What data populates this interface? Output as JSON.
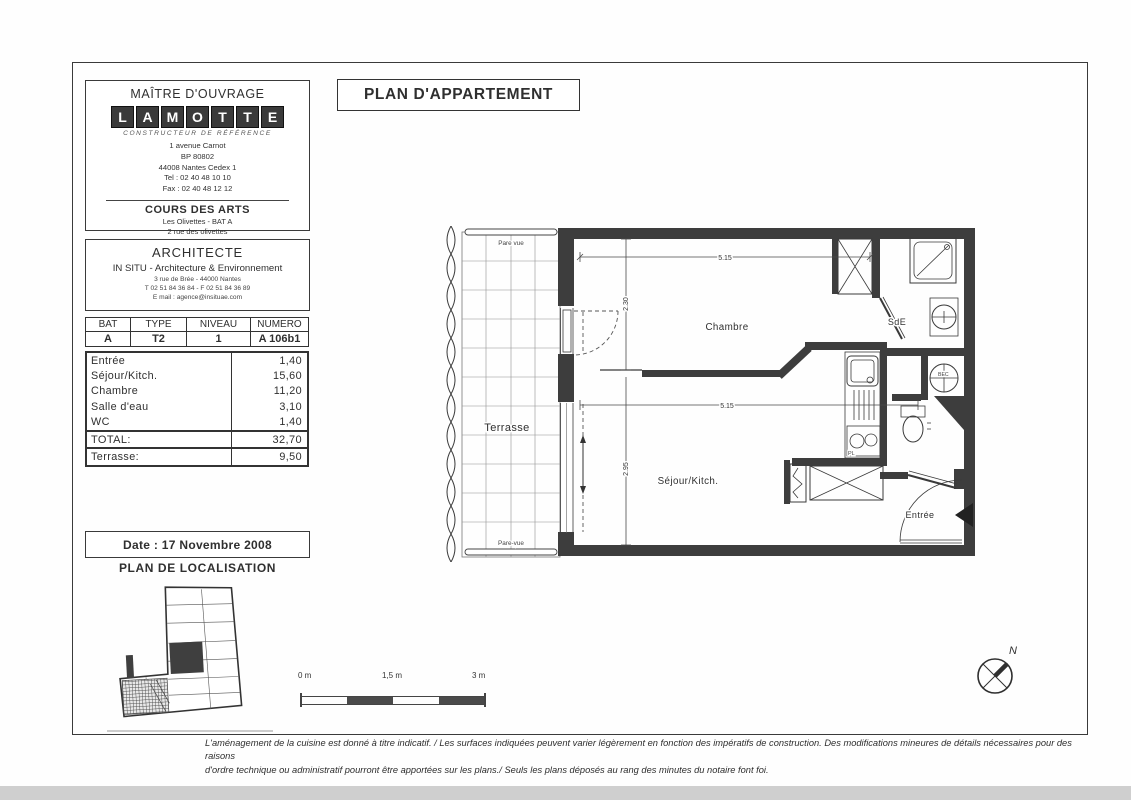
{
  "colors": {
    "ink": "#2f2f2f",
    "wall": "#3d3d3d",
    "scan_edge": "#cfcfcf"
  },
  "maitre": {
    "title": "MAÎTRE D'OUVRAGE",
    "logo_letters": [
      "L",
      "A",
      "M",
      "O",
      "T",
      "T",
      "E"
    ],
    "logo_tagline": "CONSTRUCTEUR DE RÉFÉRENCE",
    "address": [
      "1 avenue Carnot",
      "BP 80802",
      "44008 Nantes Cedex 1",
      "Tel : 02 40 48 10 10",
      "Fax : 02 40 48 12 12"
    ],
    "project": {
      "name": "COURS DES ARTS",
      "lines": [
        "Les Olivettes - BAT A",
        "2 rue des olivettes",
        "44000 Nantes"
      ]
    }
  },
  "architecte": {
    "title": "ARCHITECTE",
    "name": "IN SITU - Architecture & Environnement",
    "lines": [
      "3 rue de Brée - 44000 Nantes",
      "T 02 51 84 36 84 - F 02 51 84 36 89",
      "E mail : agence@insituae.com"
    ]
  },
  "plan_title": "PLAN D'APPARTEMENT",
  "unit_table": {
    "headers": [
      "BAT",
      "TYPE",
      "NIVEAU",
      "NUMERO"
    ],
    "values": [
      "A",
      "T2",
      "1",
      "A 106b1"
    ]
  },
  "areas": {
    "rows": [
      {
        "label": "Entrée",
        "value": "1,40"
      },
      {
        "label": "Séjour/Kitch.",
        "value": "15,60"
      },
      {
        "label": "Chambre",
        "value": "11,20"
      },
      {
        "label": "Salle d'eau",
        "value": "3,10"
      },
      {
        "label": "WC",
        "value": "1,40"
      }
    ],
    "total": {
      "label": "TOTAL:",
      "value": "32,70"
    },
    "terrasse": {
      "label": "Terrasse:",
      "value": "9,50"
    }
  },
  "date_line": "Date : 17 Novembre 2008",
  "localisation_title": "PLAN DE LOCALISATION",
  "floorplan": {
    "labels": {
      "pare_vue_top": "Pare vue",
      "pare_vue_bottom": "Pare-vue",
      "terrasse": "Terrasse",
      "chambre": "Chambre",
      "sejour": "Séjour/Kitch.",
      "sde": "SdE",
      "bec": "BEC",
      "pl": "PL",
      "entree": "Entrée"
    },
    "dimensions": {
      "width_top": "5.15",
      "width_middle": "5.15",
      "chambre_depth": "2.30",
      "sejour_depth": "2.95"
    }
  },
  "scalebar": {
    "labels": [
      "0 m",
      "1,5 m",
      "3 m"
    ]
  },
  "north_label": "N",
  "footer": {
    "line1": "L'aménagement de la cuisine est donné à titre indicatif. / Les surfaces indiquées peuvent varier légèrement en fonction des impératifs de construction. Des modifications mineures de détails nécessaires pour des raisons",
    "line2": "d'ordre technique ou administratif pourront être apportées sur les plans./ Seuls les plans déposés au rang des minutes du notaire font foi."
  }
}
